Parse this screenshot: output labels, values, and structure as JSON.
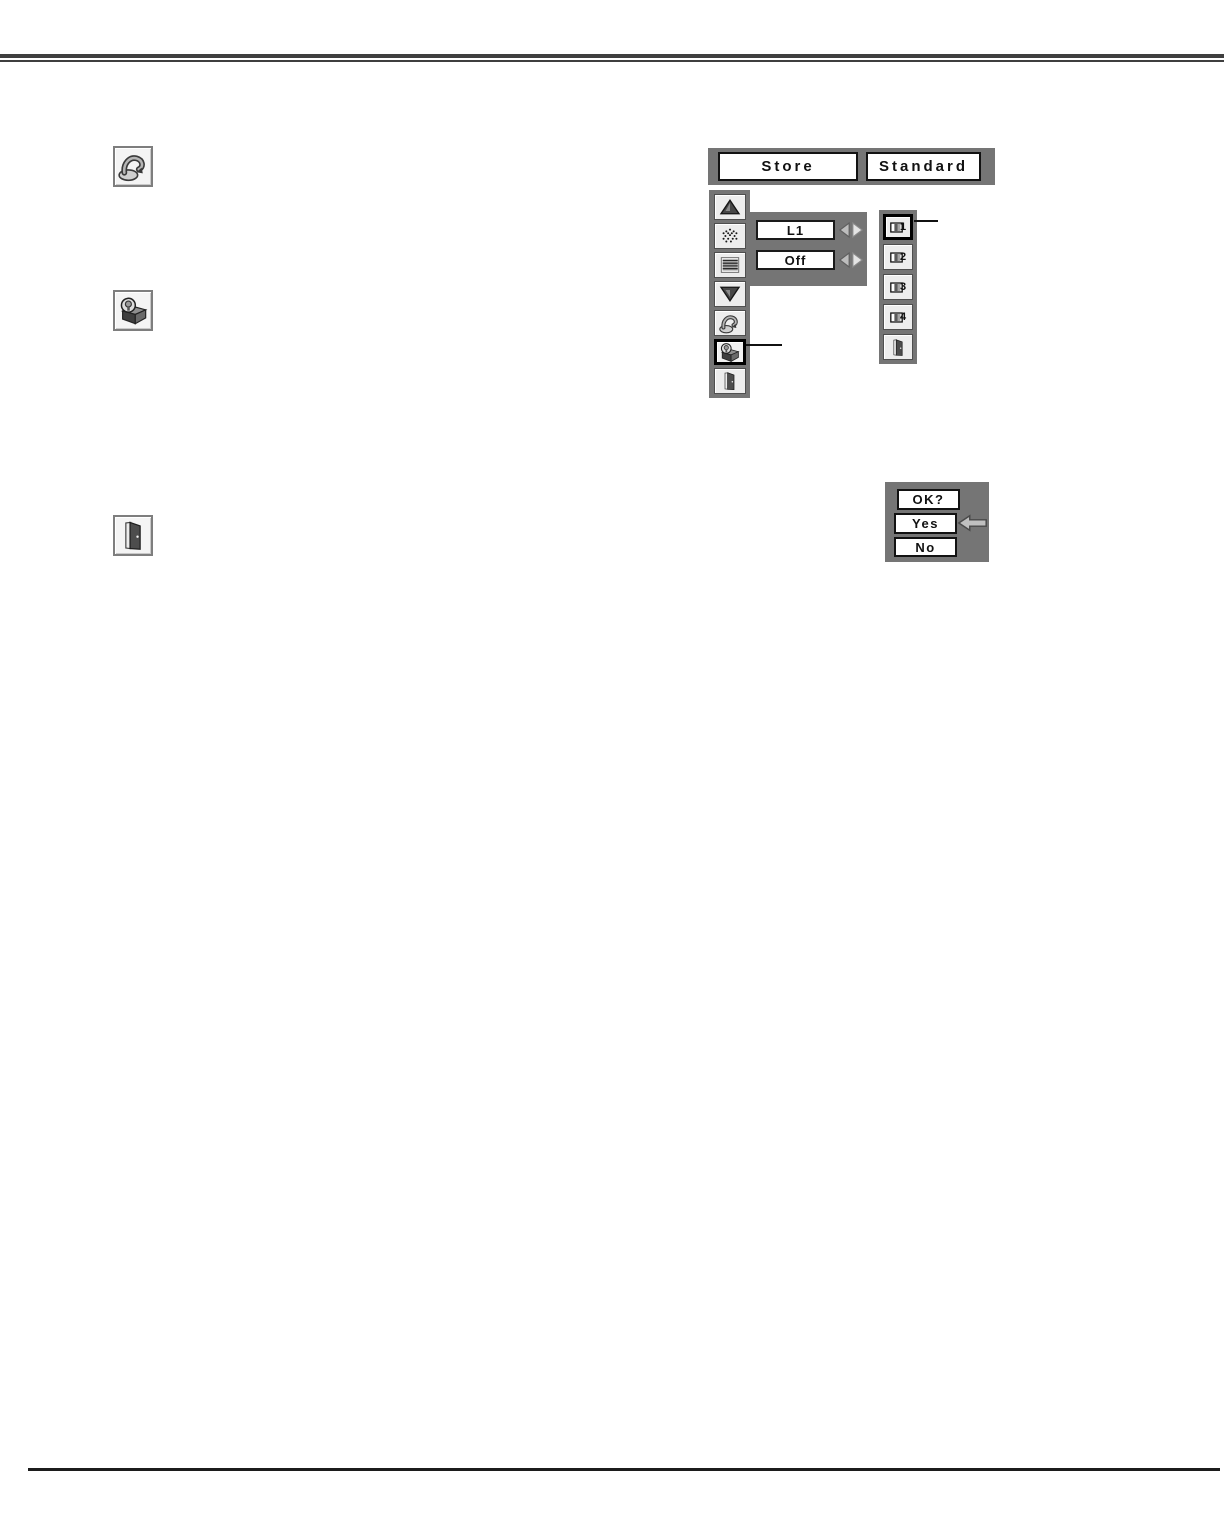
{
  "colors": {
    "panel_gray": "#757575",
    "cell_bg": "#ededed",
    "top_rule": "#3f3f3f",
    "bottom_rule": "#1c1c1c",
    "selected_border": "#000000"
  },
  "margin_icons": [
    {
      "name": "reset-icon"
    },
    {
      "name": "store-icon"
    },
    {
      "name": "quit-door-icon"
    }
  ],
  "menu": {
    "header": {
      "store": "Store",
      "standard": "Standard"
    },
    "sidebar_icons": [
      "scroll-up-icon",
      "dots-pattern-icon",
      "h-lines-icon",
      "scroll-down-icon",
      "reset-icon",
      "store-icon",
      "quit-door-icon"
    ],
    "values": {
      "box1": "L1",
      "box2": "Off"
    },
    "submenu_items": [
      {
        "label": "1",
        "icon": "image-profile-icon",
        "selected": true
      },
      {
        "label": "2",
        "icon": "image-profile-icon",
        "selected": false
      },
      {
        "label": "3",
        "icon": "image-profile-icon",
        "selected": false
      },
      {
        "label": "4",
        "icon": "image-profile-icon",
        "selected": false
      }
    ],
    "submenu_quit_icon": "quit-door-icon"
  },
  "dialog": {
    "title": "OK?",
    "yes": "Yes",
    "no": "No",
    "pointer_icon": "left-arrow-icon"
  }
}
